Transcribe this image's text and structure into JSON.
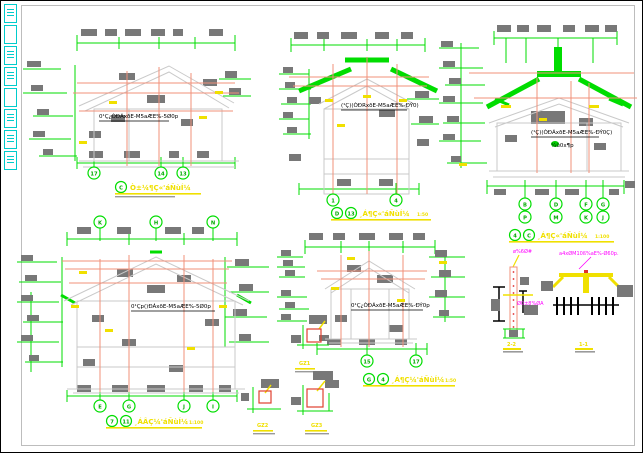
{
  "window": {
    "background": "#ffffff",
    "border_color": "#000000",
    "paper_frame_color": "#bdbdbd"
  },
  "palette": {
    "dimension_green": "#00dd00",
    "axis_salmon": "#f0907a",
    "masked_text_gray": "#787878",
    "outline_gray": "#c9c9c9",
    "caption_yellow": "#f0e000",
    "note_magenta": "#ff00ff",
    "toolbar_cyan": "#00cccc",
    "detail_red": "#e04030"
  },
  "toolbar": {
    "buttons": [
      "",
      "",
      "",
      "",
      "",
      "",
      "",
      ""
    ]
  },
  "drawings": {
    "a": {
      "annotation": "0¹Ç¿ÒÐÁxðE-M5aÆE%-5Ø0p",
      "axes": [
        "17",
        "14",
        "13"
      ],
      "caption": {
        "bubbles": [
          "C"
        ],
        "label": "Ò±¼¶Ç«'áÑùÍ¼",
        "scale": ""
      }
    },
    "b": {
      "annotation": "(¹Ç)(ÒÐRxðE-M5aÆE%-ÐÝ0)",
      "axes": [
        "1",
        "4"
      ],
      "caption": {
        "bubbles": [
          "D",
          "13"
        ],
        "label": "¸Á¶Ç«'áÑùÍ¼",
        "scale": "1:50"
      }
    },
    "c": {
      "annotation": "(¹Ç)(ÒÐÁxðE-M5aÆE%-ÐÝ0Ç)",
      "note": "¼û0x¶p",
      "axes_top": [
        "B",
        "D",
        "F",
        "G"
      ],
      "axes_bottom": [
        "P",
        "M",
        "K",
        "J"
      ],
      "caption": {
        "bubbles": [
          "4",
          "C"
        ],
        "label": "¸Á¶Ç«'áÑùÍ¼",
        "scale": "1:100"
      }
    },
    "d": {
      "annotation": "0¹Çp()ÐÁxðE-M5aÆE%-5Ø0p",
      "axes_top": [
        "K",
        "H",
        "N"
      ],
      "axes_bottom": [
        "E",
        "G",
        "J",
        "I"
      ],
      "caption": {
        "bubbles": [
          "7",
          "11"
        ],
        "label": "¸ÁÂÇ¼'áÑùÍ¼",
        "scale": "1:100"
      }
    },
    "e": {
      "annotation": "0¹Ç¿ÒÐÁxðE-M5aÆE%-ÐÝ0p",
      "axes": [
        "15",
        "17"
      ],
      "caption": {
        "bubbles": [
          "G",
          "4"
        ],
        "label": "¸Á¶Ç¼'áÑùÍ¼",
        "scale": "1:50"
      }
    },
    "column_details": {
      "labels": [
        "GZ1",
        "GZ2",
        "GZ3"
      ]
    },
    "sections": {
      "left": {
        "top_note": "ø%6Ø#",
        "mid_note": "Ø0±8%ØA",
        "label": "2-2"
      },
      "right": {
        "top_note": "a4xØM10ß%aE%-Ø60p.",
        "label": "1-1"
      }
    }
  }
}
